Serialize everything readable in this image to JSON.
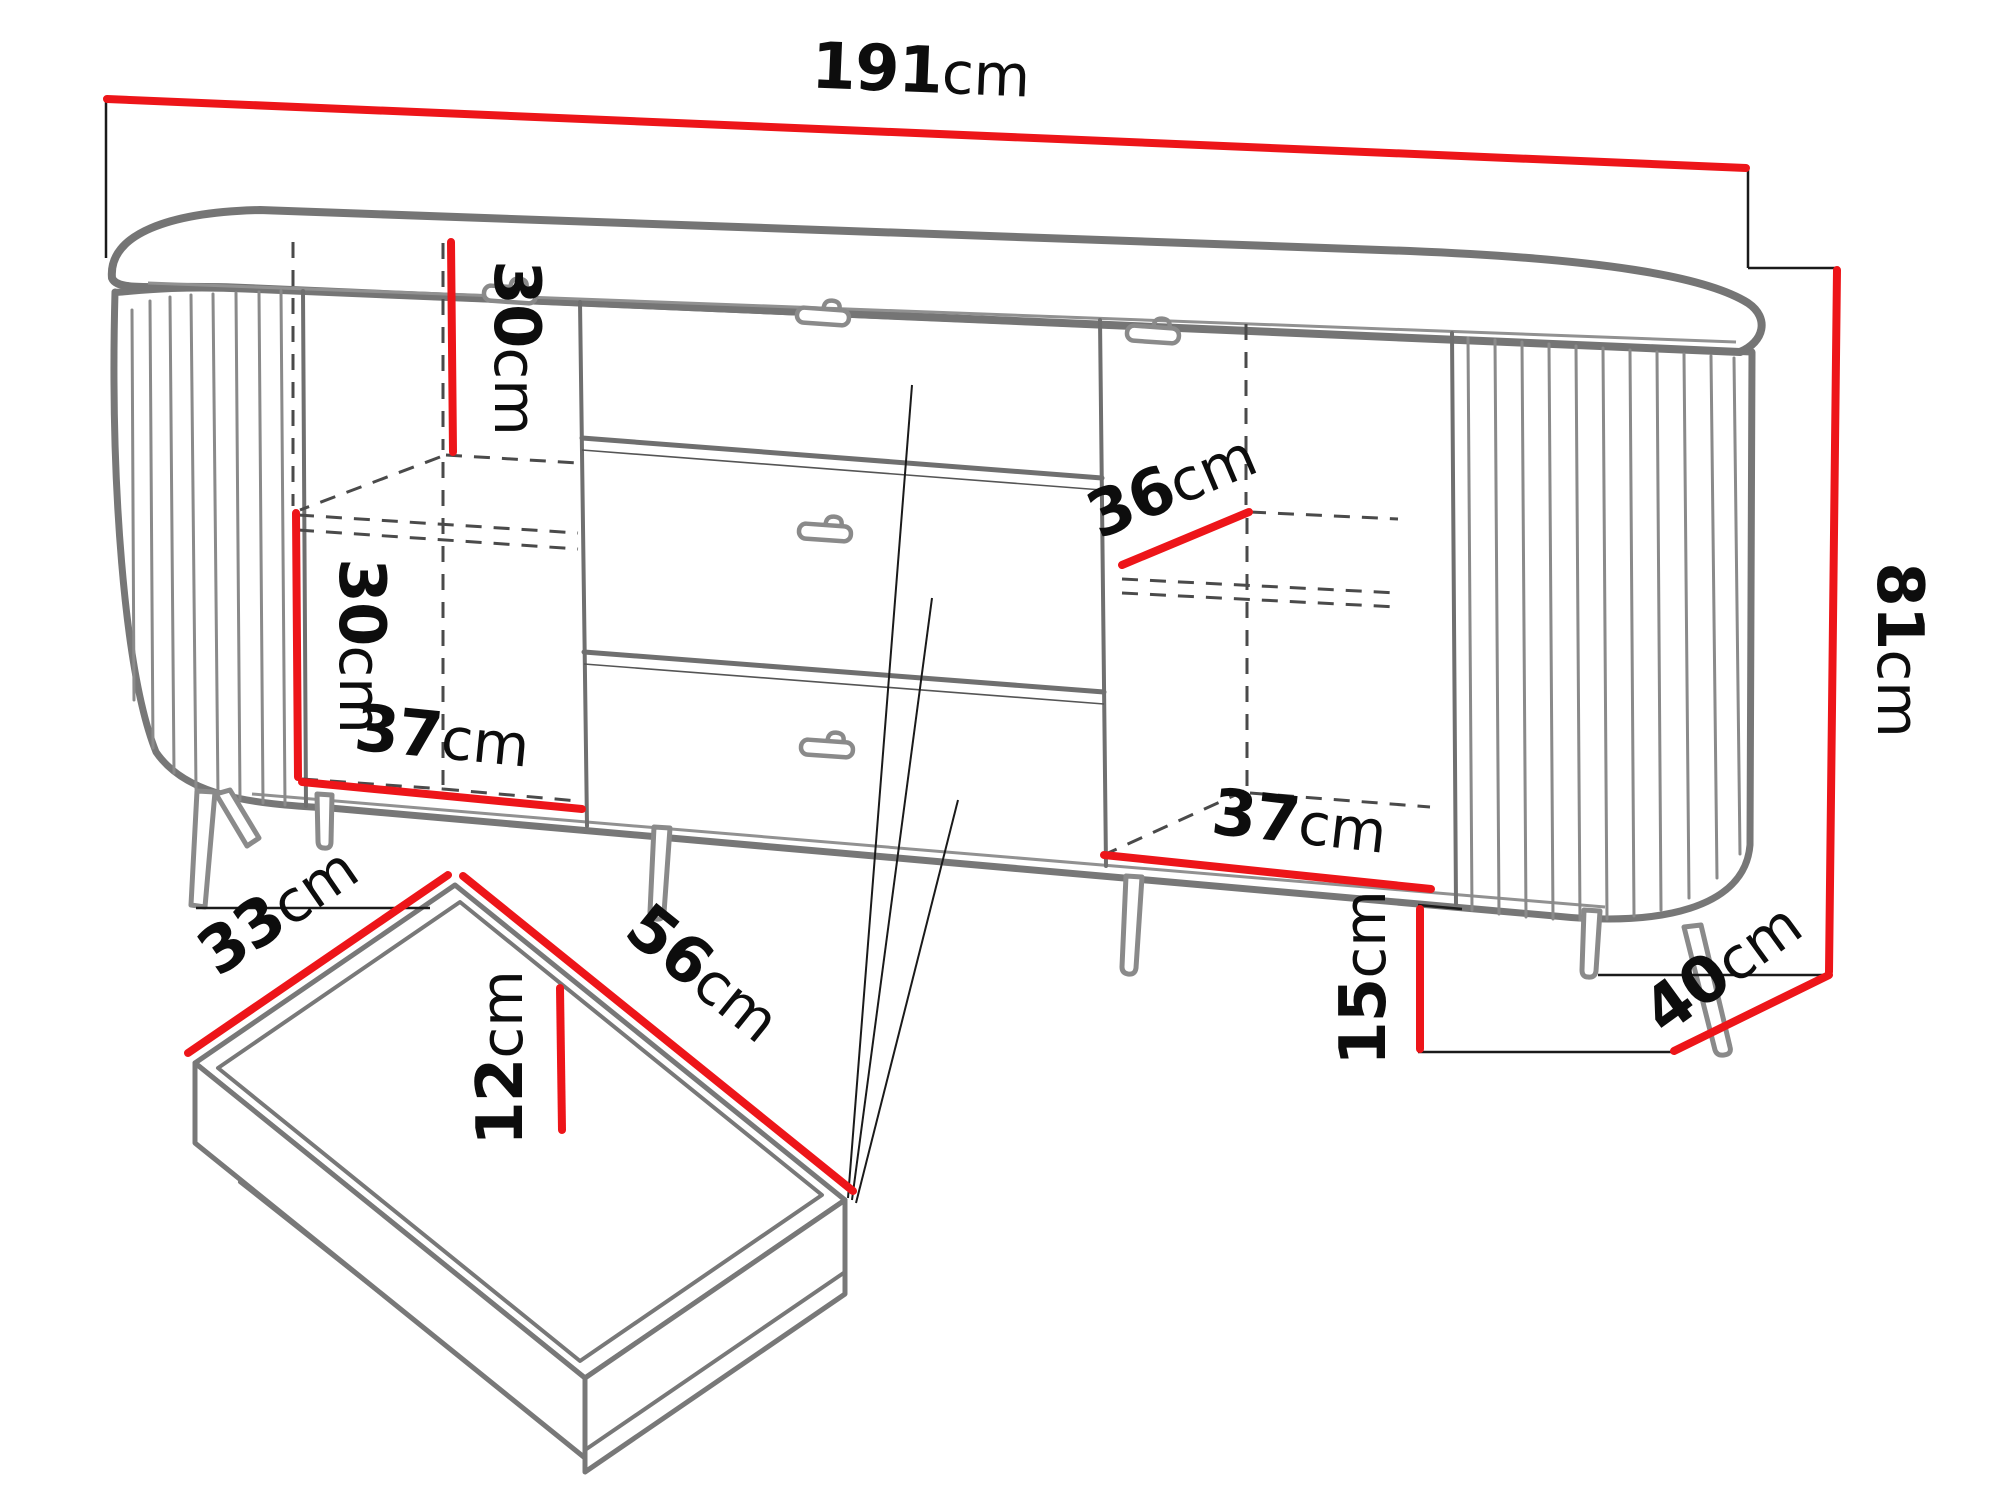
{
  "diagram": {
    "kind": "furniture-dimension-drawing",
    "subject": "sideboard with two fluted rounded doors, three central drawers, metal legs, plus exploded inner-drawer detail",
    "unit": "cm",
    "accent_color": "#ed1519",
    "line_color": "#777777",
    "text_color": "#0d0d0d"
  },
  "dimensions": {
    "total_width": {
      "value": "191",
      "unit": "cm"
    },
    "total_height": {
      "value": "81",
      "unit": "cm"
    },
    "total_depth": {
      "value": "40",
      "unit": "cm"
    },
    "leg_height": {
      "value": "15",
      "unit": "cm"
    },
    "left_upper_compartment": {
      "value": "30",
      "unit": "cm"
    },
    "left_lower_compartment": {
      "value": "30",
      "unit": "cm"
    },
    "left_compartment_width": {
      "value": "37",
      "unit": "cm"
    },
    "right_shelf_depth": {
      "value": "36",
      "unit": "cm"
    },
    "right_compartment_width": {
      "value": "37",
      "unit": "cm"
    },
    "drawer_depth": {
      "value": "33",
      "unit": "cm"
    },
    "drawer_width": {
      "value": "56",
      "unit": "cm"
    },
    "drawer_inner_height": {
      "value": "12",
      "unit": "cm"
    }
  }
}
